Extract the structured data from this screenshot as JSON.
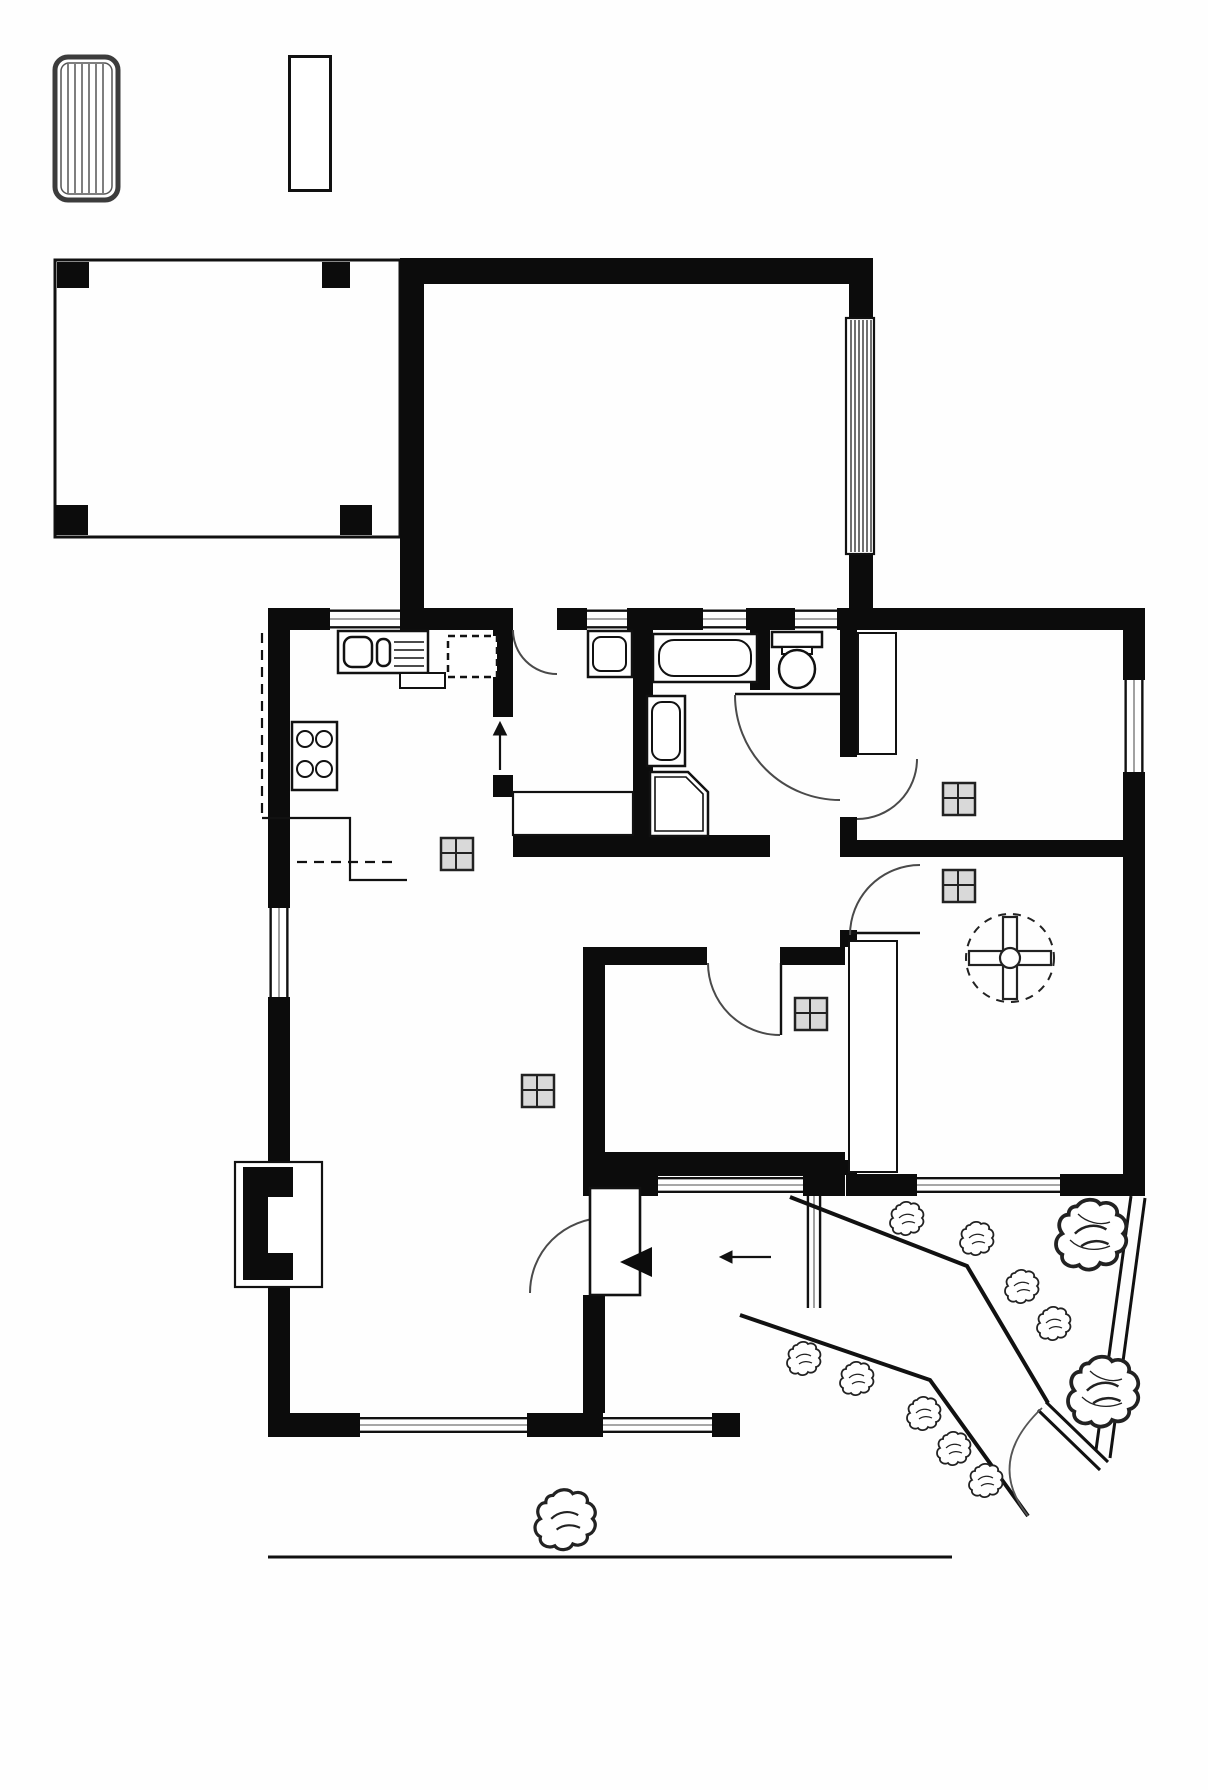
{
  "outdoor": {
    "clothesline": "C/L",
    "shed": "SHED",
    "step": "STEP",
    "gate": "GATE"
  },
  "rooms": {
    "pergola": {
      "name": "PERGOLA",
      "dims": "4.80 X 4.00"
    },
    "garage": {
      "name": "GARAGE",
      "dims": "5.30 X 4.00"
    },
    "kitchen": {
      "name": "KITCHEN",
      "dims": "2.70 X 2.86"
    },
    "laundry": {
      "name": "L'DRY"
    },
    "bedroom3": {
      "name": "BEDROOM 3",
      "dims": "3.30 X 2.70"
    },
    "bedroom1": {
      "name": "BEDROOM 1",
      "dims": "3.30 X 4.10"
    },
    "bedroom2": {
      "name": "BEDROOM 2",
      "dims": "3.26 X 2.80"
    },
    "living": {
      "name_line1": "LIVING /",
      "name_line2": "MEALS",
      "dims": "3.80 X 7.00"
    },
    "patio": {
      "name": "PATIO"
    }
  },
  "fixtures": {
    "auto_roller_door_line1": "AUTO",
    "auto_roller_door_line2": "ROLLER",
    "auto_roller_door_line3": "-DOOR",
    "dishwasher": "D/W",
    "fridge": "FR",
    "built_in_cupboard": "BIC",
    "shower": "SHR",
    "breakfast_bar": "B/BAR",
    "robe_bed3": "ROBE",
    "robe_bed1": "ROBE",
    "heater": "HEATER"
  },
  "disclaimer": {
    "line1": "This drawing is for illustration purposes only .",
    "line2": "All measurements are approximate and details intended",
    "line3": "to be relied upon should be independently verified."
  }
}
